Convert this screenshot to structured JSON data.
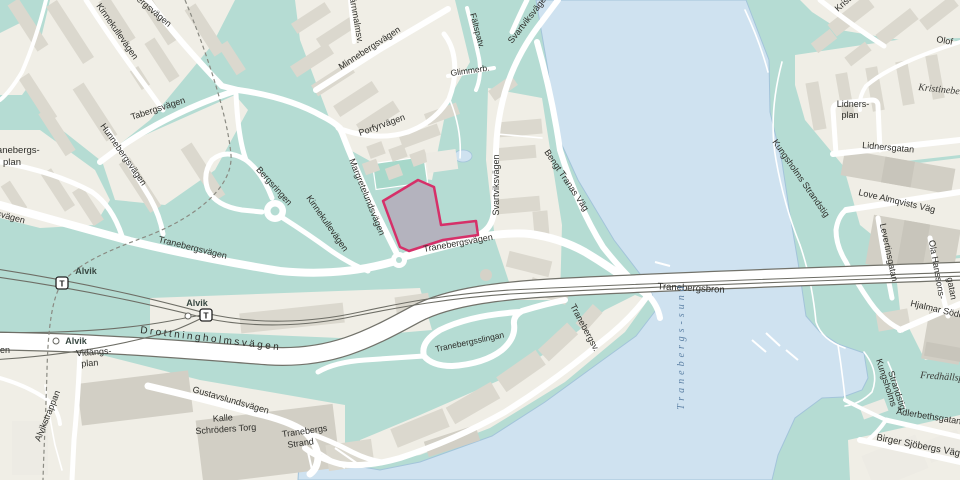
{
  "map": {
    "labels": {
      "mossebergsvagen": "Mössebergsvägen",
      "kinnekullevagen_north": "Kinnekullevägen",
      "kinnekullevagen_south": "Kinnekullevägen",
      "tabergsvagen": "Tabergsvägen",
      "hunnebergsvagen": "Hunnebergsvägen",
      "tranebergsplan_line1": "Tranebergs-",
      "tranebergsplan_line2": "plan",
      "bergsringen": "Bergsringen",
      "margretelundsvagen": "Margretelundsvägen",
      "jarnmalmsvagen": "Järnmalmsv.",
      "minnebergsvagen": "Minnebergsvägen",
      "porfyrvagen": "Porfyrvägen",
      "faltspatvagen": "Fältspatv.",
      "glimmerbacken": "Glimmerb.",
      "svartviksvagen_top": "Svartviksvägen",
      "svartviksvagen_mid": "Svartviksvägen",
      "bengt_tranas_vag": "Bengt Tranas Väg",
      "tranebergsvagen_west": "Tranebergsvägen",
      "tranebergsvagen_east": "Tranebergsvägen",
      "tranebergsvagen_shore": "Tranebergsv.",
      "tranebergsslingan": "Tranebergsslingan",
      "tranebergsbron": "Tranebergsbron",
      "tranebergs_sund": "Tranebergs-sund",
      "drottningholmsvagen": "Drottningholmsvägen",
      "alvik": "Alvik",
      "vidangsplan_line1": "Vidängs-",
      "vidangsplan_line2": "plan",
      "alvikstrappan": "Alvikstrappan",
      "gustavslundsvagen": "Gustavslundsvägen",
      "kalle_schroders_torg_line1": "Kalle",
      "kalle_schroders_torg_line2": "Schröders Torg",
      "tranebergs_strand_line1": "Tranebergs",
      "tranebergs_strand_line2": "Strand",
      "lidnersplan_line1": "Lidners-",
      "lidnersplan_line2": "plan",
      "lidnersgatan": "Lidnersgatan",
      "love_almqvists_vag": "Love Almqvists Väg",
      "levertinsgatan": "Levertinsgatan",
      "ola_hanssonsgatan_line1": "Ola Hanssons-",
      "ola_hanssonsgatan_line2": "gatan",
      "hjalmar_soderbergs_vag": "Hjalmar Söderbergs Väg",
      "kungsholms_strandstig": "Kungsholms Strandstig",
      "kungsholms_strandstig_line1": "Kungsholms",
      "kungsholms_strandstig_line2": "Strandstig",
      "kristineberg": "Kristineberg",
      "kristineberg_fragment": "Kristineb",
      "olof": "Olof",
      "fredhallsparken": "Fredhällsparken",
      "adlerbethsgatan": "Adlerbethsgatan",
      "birger_sjobergs_vag": "Birger Sjöbergs Väg",
      "svagen_fragment": "svägen",
      "en_fragment": "en",
      "t_symbol": "T"
    },
    "colors": {
      "water": "#cfe2f0",
      "parkland": "#b5dcd3",
      "urban_block": "#f0eee6",
      "building": "#dbd8ce",
      "road": "#ffffff",
      "rail": "#6e6e66",
      "highlight_outline": "#d63069",
      "highlight_fill": "#b4b3be",
      "water_label": "#5e82a6"
    },
    "highlight": {
      "type": "selected-parcel-outline",
      "street": "Tranebergsvägen"
    }
  }
}
